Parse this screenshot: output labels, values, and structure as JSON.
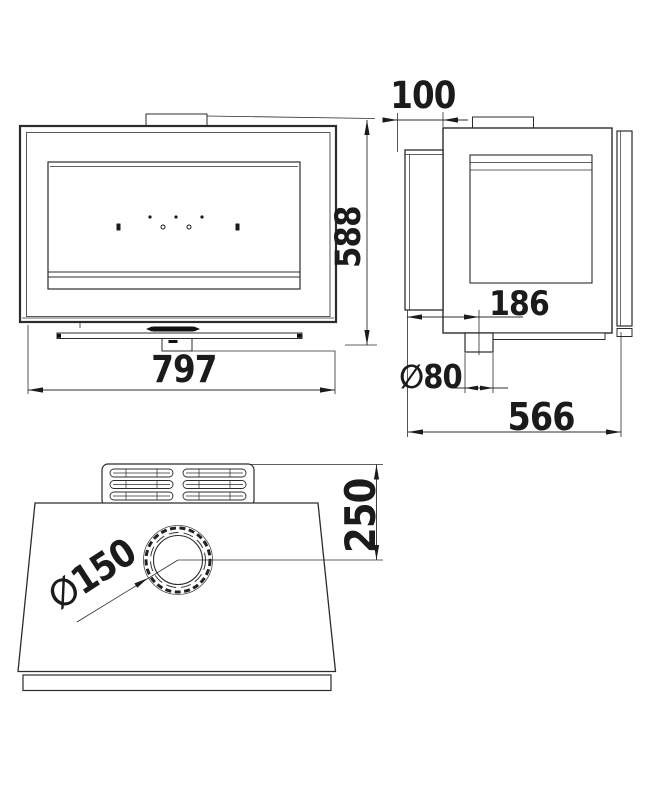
{
  "drawing": {
    "title": "stove-three-view-dimension-drawing",
    "colors": {
      "line": "#2c2c2c",
      "text": "#1b1b1b",
      "background": "#ffffff"
    },
    "front": {
      "name": "front-view",
      "width": "797",
      "height": "588"
    },
    "side": {
      "name": "side-view",
      "flue_offset": "100",
      "outlet_offset": "186",
      "outlet_diameter": "∅80",
      "depth": "566"
    },
    "top": {
      "name": "top-view",
      "flue_center_offset": "250",
      "flue_diameter": "∅150"
    }
  }
}
